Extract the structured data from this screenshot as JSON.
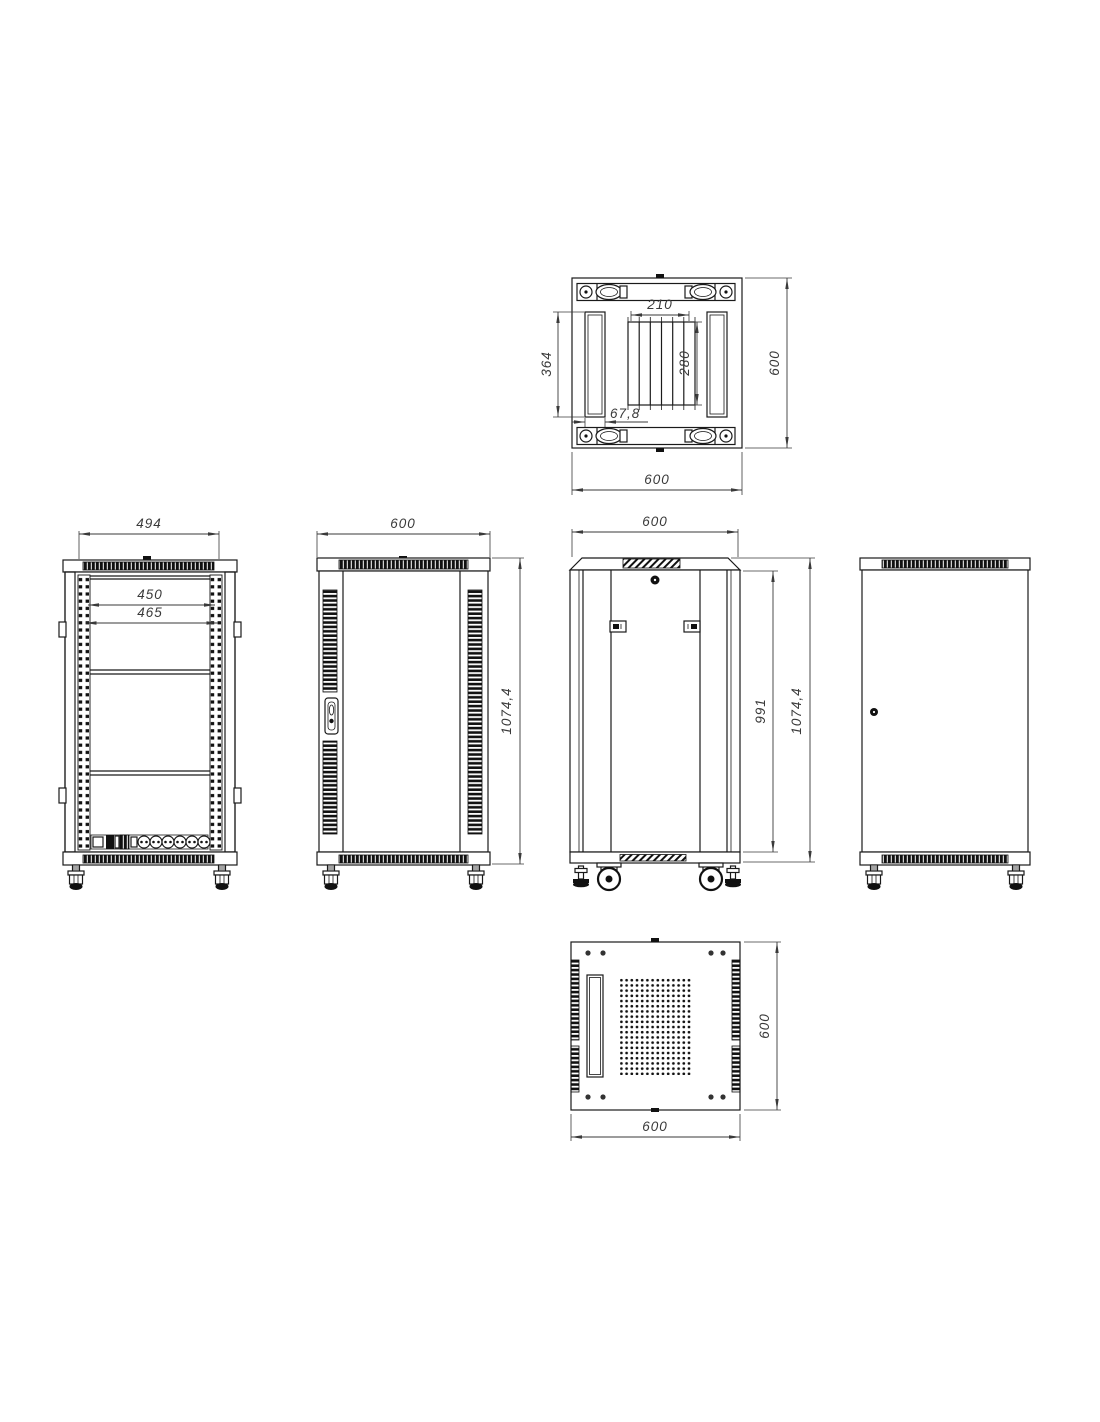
{
  "title": "Rack cabinet technical drawing - six orthographic views",
  "colors": {
    "background": "#ffffff",
    "line": "#1a1a1a",
    "dim": "#3a3a3a"
  },
  "views": {
    "top": {
      "label": "top-view",
      "dim_vent_width": "210",
      "dim_vent_height": "280",
      "dim_rail_length": "364",
      "dim_rail_width": "67,8",
      "dim_depth": "600",
      "dim_width": "600"
    },
    "front_open": {
      "label": "front-open-view",
      "dim_frame_width": "494",
      "dim_rail_inner_width": "450",
      "dim_rail_outer_width": "465"
    },
    "front_door": {
      "label": "front-door-view",
      "dim_width": "600",
      "dim_height": "1074,4"
    },
    "rear": {
      "label": "rear-view",
      "dim_width": "600",
      "dim_door_height": "991",
      "dim_height": "1074,4"
    },
    "side": {
      "label": "side-view"
    },
    "bottom": {
      "label": "bottom-view",
      "dim_depth": "600",
      "dim_width": "600"
    }
  }
}
